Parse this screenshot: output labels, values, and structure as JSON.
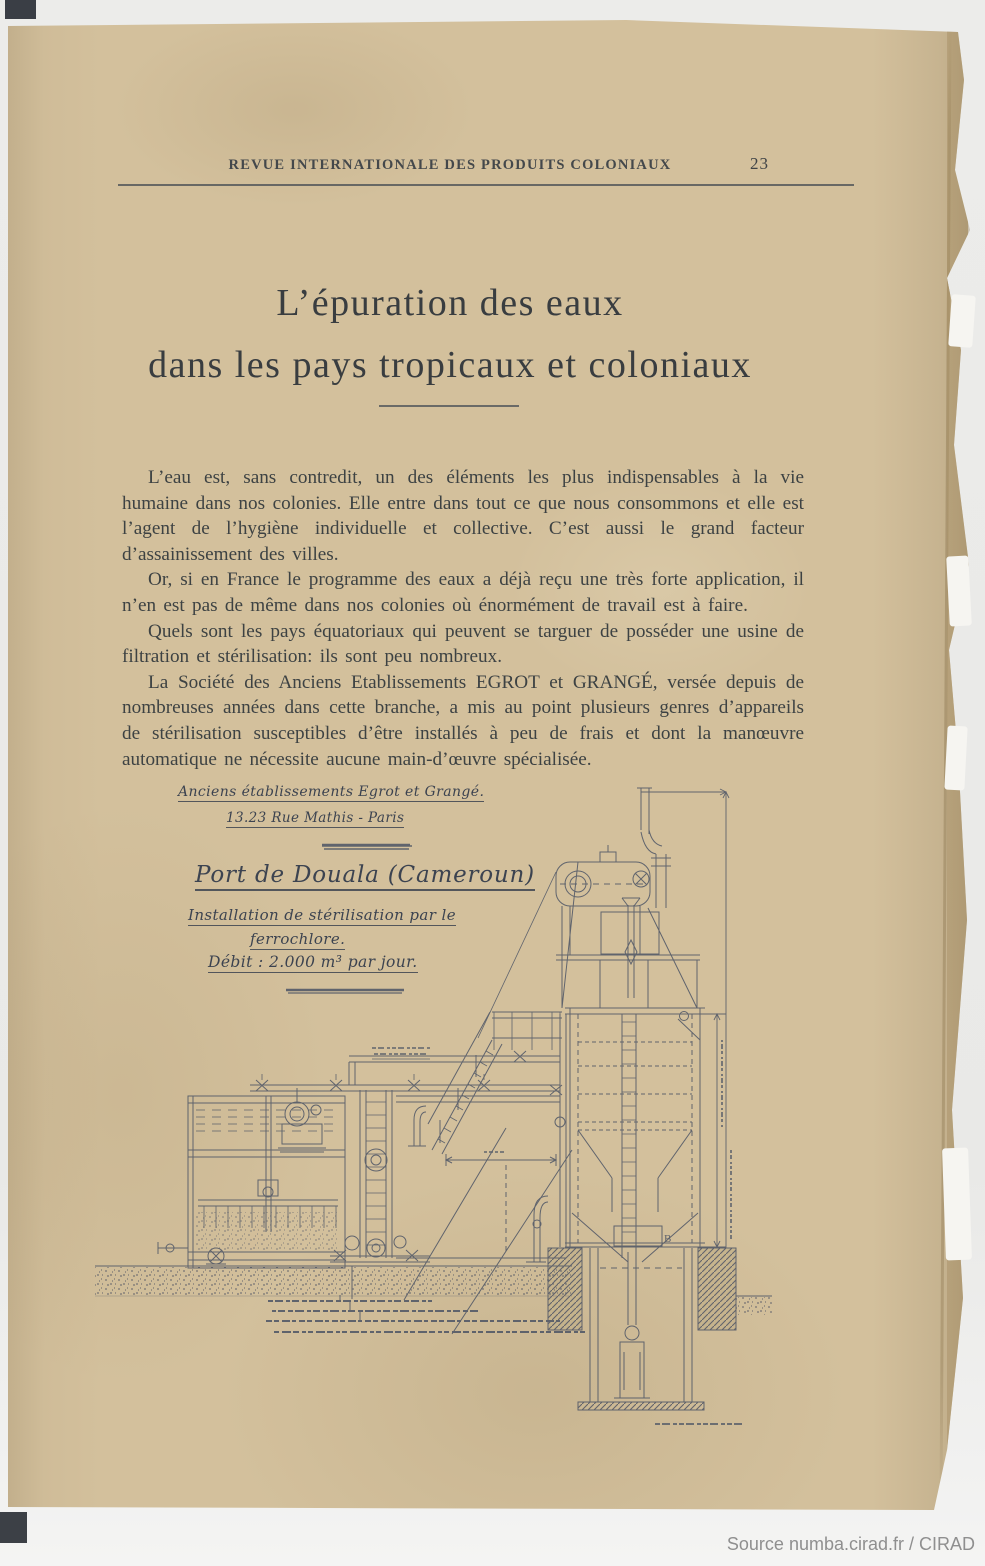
{
  "colors": {
    "page": "#d3c09c",
    "ink": "#475063",
    "body_text": "#3d4243",
    "source_text": "#8f8f8f"
  },
  "header": {
    "journal": "REVUE INTERNATIONALE DES PRODUITS COLONIAUX",
    "page_number": "23"
  },
  "article": {
    "title_line1": "L’épuration des eaux",
    "title_line2": "dans les pays tropicaux et coloniaux",
    "paragraphs": [
      "L’eau est, sans contredit, un des éléments les plus indispensables à la vie humaine dans nos colonies. Elle entre dans tout ce que nous consommons et elle est l’agent de l’hygiène individuelle et collective. C’est aussi le grand facteur d’assainissement des villes.",
      "Or, si en France le programme des eaux a déjà reçu une très forte application, il n’en est pas de même dans nos colonies où énormément de travail est à faire.",
      "Quels sont les pays équatoriaux qui peuvent se targuer de posséder une usine de filtration et stérilisation: ils sont peu nombreux.",
      "La Société des Anciens Etablissements EGROT et GRANGÉ, versée depuis de nombreuses années dans cette branche, a mis au point plusieurs genres d’appareils de stérilisation susceptibles d’être installés à peu de frais et dont la manœuvre automatique ne nécessite aucune main-d’œuvre spécialisée."
    ]
  },
  "figure": {
    "firm_line1": "Anciens établissements Egrot et Grangé.",
    "firm_line2": "13.23 Rue Mathis - Paris",
    "location": "Port de Douala (Cameroun)",
    "subtitle_line1": "Installation de stérilisation par le",
    "subtitle_line2": "ferrochlore.",
    "flow_rate": "Débit : 2.000 m³ par jour.",
    "part_label": "B"
  },
  "footer": {
    "source": "Source numba.cirad.fr / CIRAD"
  }
}
